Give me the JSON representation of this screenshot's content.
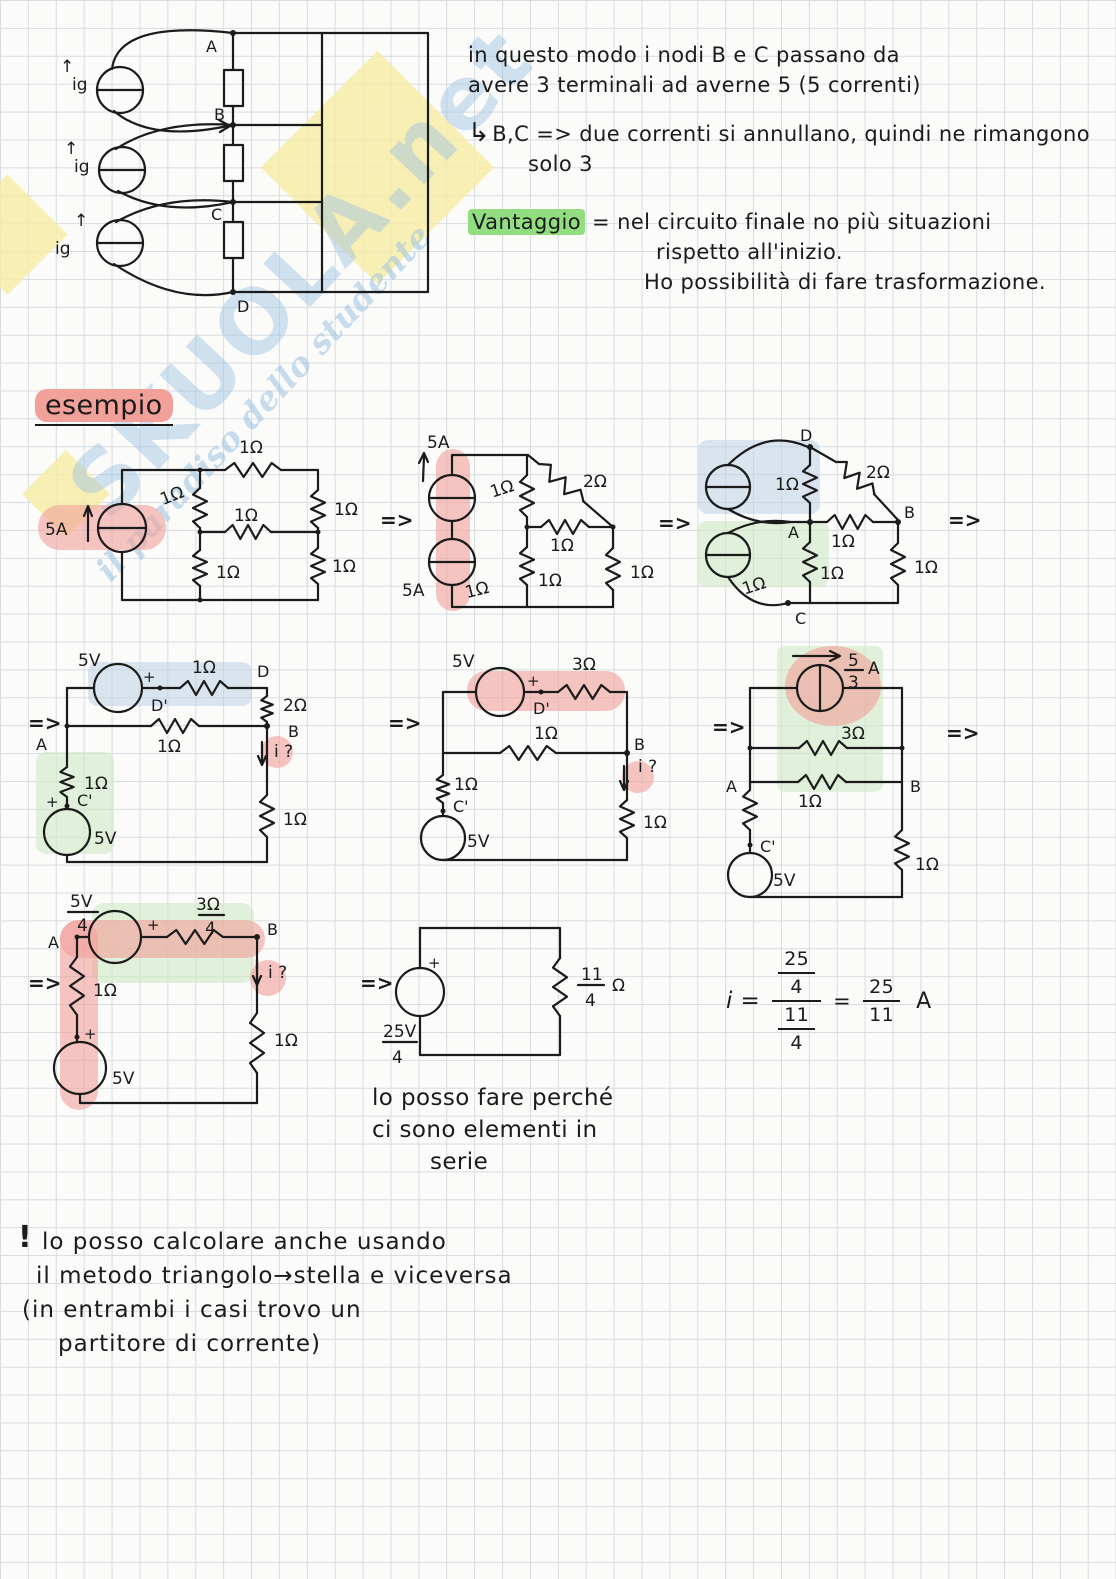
{
  "colors": {
    "ink": "#1b1b1b",
    "paper": "#fbfbfa",
    "grid": "#d7dce1",
    "hl_pink": "#f2a09a",
    "hl_green": "#92dd80",
    "band_blue": "#bed2e6",
    "band_green": "#cfe9c5",
    "wm_blue": "#9cc2e2",
    "wm_yellow": "#f7eca4"
  },
  "watermark": {
    "brand": "SKUOLA.net",
    "tagline": "il paradiso dello studente"
  },
  "sym": {
    "arrow": "=>",
    "up_arrow": "↑",
    "plus": "+",
    "r1": "1Ω",
    "r2": "2Ω",
    "r3": "3Ω",
    "a5": "5A",
    "v5": "5V",
    "ig": "ig",
    "iq": "i ?"
  },
  "notes_top": {
    "l1": "in questo modo i nodi B e C passano da",
    "l2": "avere 3 terminali ad averne 5 (5 correnti)",
    "branch_prefix": "↳",
    "b1": "B,C => due correnti si annullano, quindi ne rimangono",
    "b2": "solo 3",
    "v_label": "Vantaggio",
    "v1": "= nel circuito finale no più situazioni",
    "v2": "rispetto all'inizio.",
    "v3": "Ho possibilità di fare trasformazione."
  },
  "esempio_title": "esempio",
  "fig1": {
    "nA": "A",
    "nB": "B",
    "nC": "C",
    "nD": "D"
  },
  "r1c3": {
    "nA": "A",
    "nB": "B",
    "nC": "C",
    "nD": "D"
  },
  "r2c1": {
    "nDp": "D'",
    "nD": "D",
    "nB": "B",
    "nA": "A",
    "nCp": "C'"
  },
  "r2c2": {
    "nDp": "D'",
    "nB": "B",
    "nCp": "C'"
  },
  "r2c3": {
    "nA": "A",
    "nB": "B",
    "nCp": "C'",
    "fnum": "5",
    "fden": "3",
    "funit": "A"
  },
  "r3c1": {
    "vnum": "5V",
    "vden": "4",
    "rnum": "3Ω",
    "rden": "4",
    "nA": "A",
    "nB": "B"
  },
  "r3c2": {
    "vnum": "25V",
    "vden": "4",
    "rnum": "11",
    "rden": "4",
    "runit": "Ω"
  },
  "series_note": {
    "l1": "lo posso fare perché",
    "l2": "ci sono elementi in",
    "l3": "serie"
  },
  "formula": {
    "lhs": "i =",
    "n_num": "25",
    "n_den": "4",
    "d_num": "11",
    "d_den": "4",
    "eq": "=",
    "r_num": "25",
    "r_den": "11",
    "unit": "A"
  },
  "bottom_note": {
    "bang": "!",
    "l1": "lo posso calcolare anche usando",
    "l2": "il metodo triangolo→stella e viceversa",
    "l3": "(in entrambi i casi trovo un",
    "l4": "partitore di corrente)"
  }
}
